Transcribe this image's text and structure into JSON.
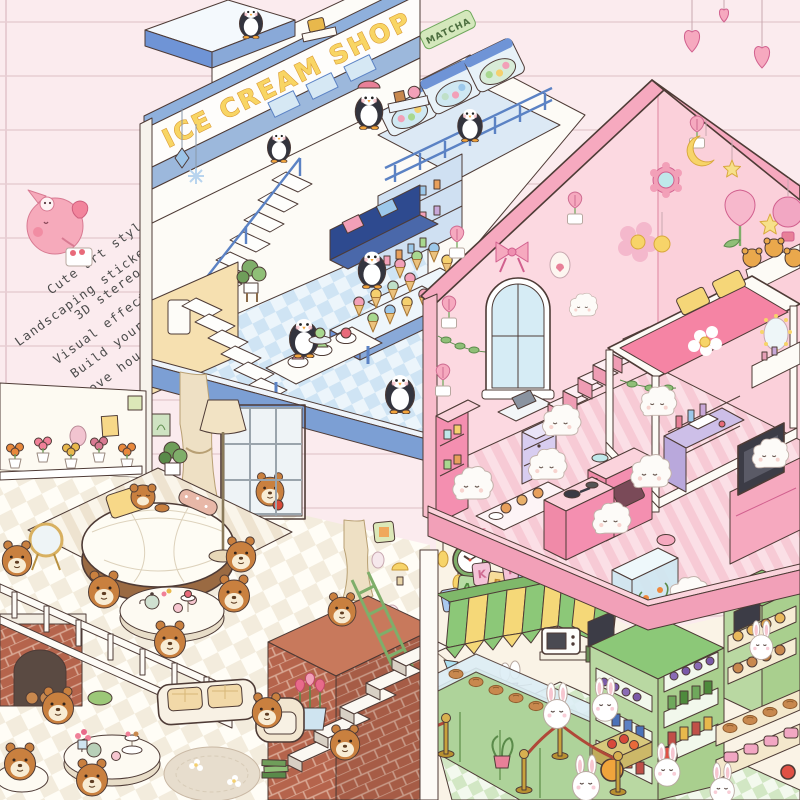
{
  "scene": {
    "description": "Cute isometric love-house landscaping sticker scene on pink lined paper: ice cream shop with penguins, pink bedroom with fluffy friends, bear lounge and rabbit bakery"
  },
  "note": {
    "lines": [
      "Cute art style",
      "Landscaping sticker",
      "3D stereo",
      "Visual effect",
      "Build yours",
      "Dream of a love house"
    ]
  },
  "rooms": {
    "ice_cream_shop": {
      "sign": "ICE CREAM SHOP",
      "freezer_label": "MATCHA",
      "residents": "penguins"
    },
    "pink_bedroom": {
      "residents": "fluffy pink friends"
    },
    "bear_lounge": {
      "residents": "bears"
    },
    "bakery": {
      "sign_letters": [
        "B",
        "A",
        "K",
        "E",
        "R",
        "Y"
      ],
      "clock_time": "10:10",
      "residents": "rabbits"
    }
  },
  "palette": {
    "paper": "#fbebee",
    "paper_line": "#ecd5d9",
    "shop_blue": "#7c9fd4",
    "sign_yellow": "#f8d564",
    "pink_wall": "#fcd9e1",
    "pink_accent": "#f6a9bf",
    "bear_brown": "#c9803f",
    "cream": "#faf3e6",
    "bakery_green": "#8cc878",
    "awning_yellow": "#f5d878"
  }
}
